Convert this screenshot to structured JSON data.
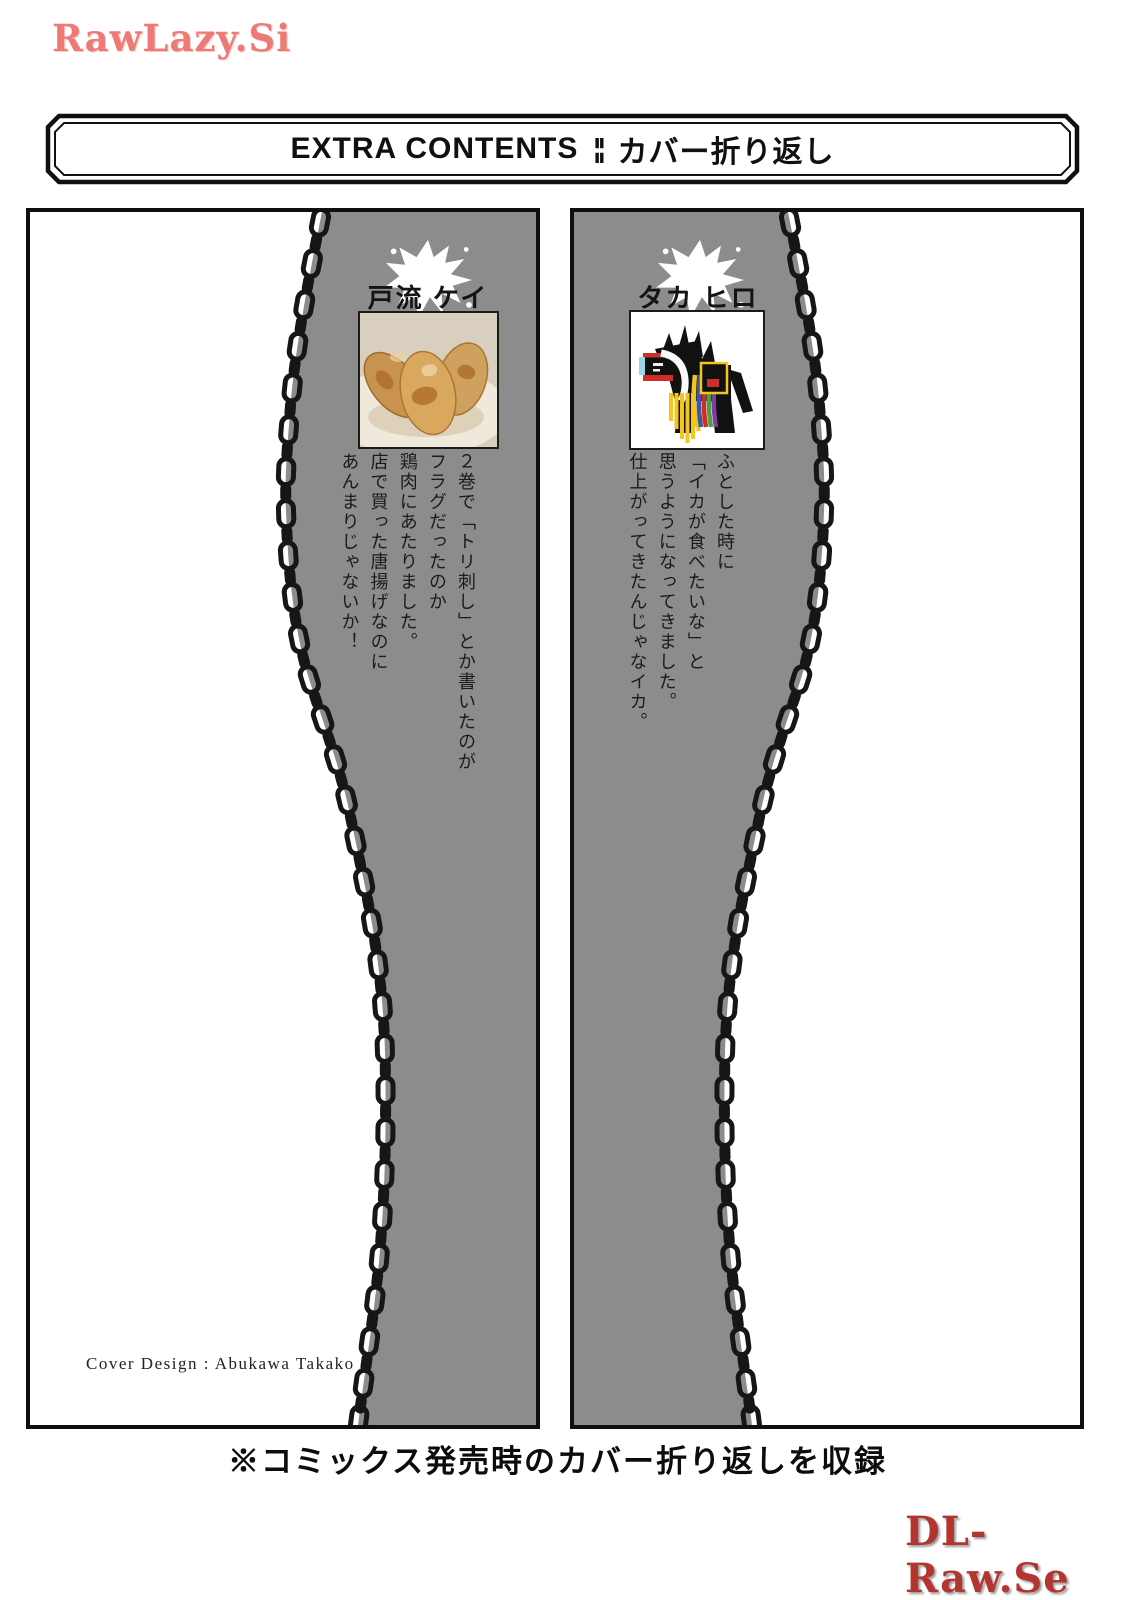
{
  "page": {
    "watermark_top": "RawLazy.Si",
    "watermark_bottom": "DL-Raw.Se"
  },
  "header": {
    "title_en": "EXTRA CONTENTS",
    "separator": "¦¦",
    "title_jp": "カバー折り返し"
  },
  "panels": {
    "left": {
      "author": "戸流 ケイ",
      "photo": "gyoza-dumplings-photo",
      "comment": [
        "２巻で「トリ刺し」とか書いたのが",
        "フラグだったのか",
        "鶏肉にあたりました。",
        "店で買った唐揚げなのに",
        "あんまりじゃないか！"
      ],
      "credit": "Cover Design : Abukawa Takako"
    },
    "right": {
      "author": "タカ ヒロ",
      "photo": "chagu-chagu-horse-toy-photo",
      "comment": [
        "ふとした時に",
        "「イカが食べたいな」と",
        "思うようになってきました。",
        "仕上がってきたんじゃなイカ。"
      ]
    }
  },
  "footer": {
    "note": "※コミックス発売時のカバー折り返しを収録"
  },
  "colors": {
    "panel-gray": "#8c8c8c",
    "chain": "#161616",
    "watermark-top": "#ee7a76",
    "watermark-bottom": "#b23530"
  }
}
